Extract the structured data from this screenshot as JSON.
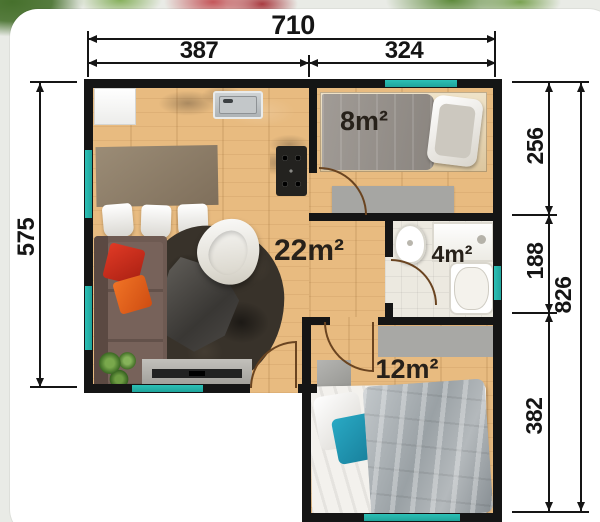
{
  "floorplan": {
    "dims": {
      "w_total": "710",
      "w_left": "387",
      "w_right": "324",
      "h_left": "575",
      "r_top": "256",
      "r_mid": "188",
      "r_bottom": "382",
      "r_total": "826"
    },
    "rooms": {
      "living": {
        "label": "22m²"
      },
      "bed8": {
        "label": "8m²"
      },
      "bath": {
        "label": "4m²"
      },
      "bed12": {
        "label": "12m²"
      }
    },
    "colors": {
      "window_accent": "#23b2a9",
      "wall": "#151515",
      "wood_floor": "#e8bb80",
      "door_swing": "#6a4420",
      "dimension_text": "#151515"
    }
  }
}
